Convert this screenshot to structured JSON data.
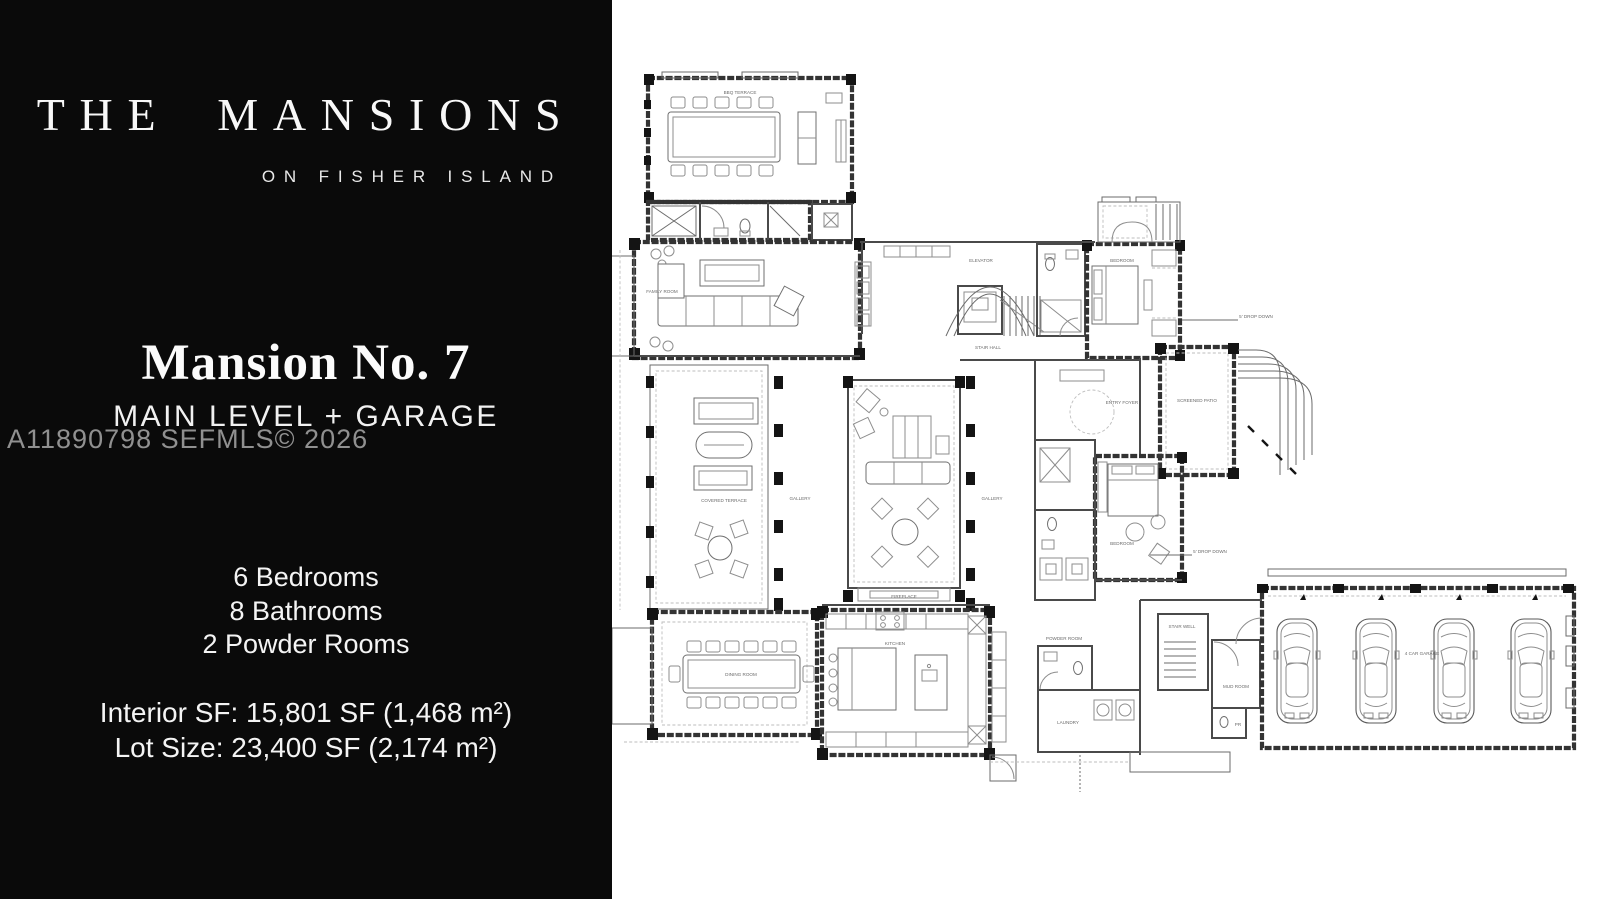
{
  "left_panel": {
    "brand": {
      "line1": "THE MANSIONS",
      "line2": "ON FISHER ISLAND"
    },
    "title": "Mansion No. 7",
    "subtitle": "MAIN LEVEL + GARAGE",
    "stats": [
      "6 Bedrooms",
      "8 Bathrooms",
      "2 Powder Rooms"
    ],
    "interior_sf": "Interior SF: 15,801 SF (1,468 m²)",
    "lot_size": "Lot Size: 23,400 SF (2,174 m²)"
  },
  "watermark": "A11890798  SEFMLS© 2026",
  "floor_plan": {
    "labels": {
      "bbq_terrace": "BBQ TERRACE",
      "family_room": "FAMILY ROOM",
      "elevator": "ELEVATOR",
      "stair_hall": "STAIR HALL",
      "bedroom": "BEDROOM",
      "entry_foyer": "ENTRY FOYER",
      "screened_patio": "SCREENED PATIO",
      "covered_terrace": "COVERED TERRACE",
      "gallery": "GALLERY",
      "fireplace": "FIREPLACE",
      "dining_room": "DINING ROOM",
      "kitchen": "KITCHEN",
      "powder_room": "POWDER ROOM",
      "laundry": "LAUNDRY",
      "stair_well": "STAIR WELL",
      "mud_room": "MUD ROOM",
      "garage": "4 CAR GARAGE",
      "pr": "PR"
    },
    "annotations": {
      "drop_down": "5' DROP DOWN"
    }
  },
  "colors": {
    "panel_bg": "#0a0a0a",
    "panel_text": "#f5f5f5",
    "watermark": "#a8a8a8",
    "plan_line": "#444444"
  }
}
